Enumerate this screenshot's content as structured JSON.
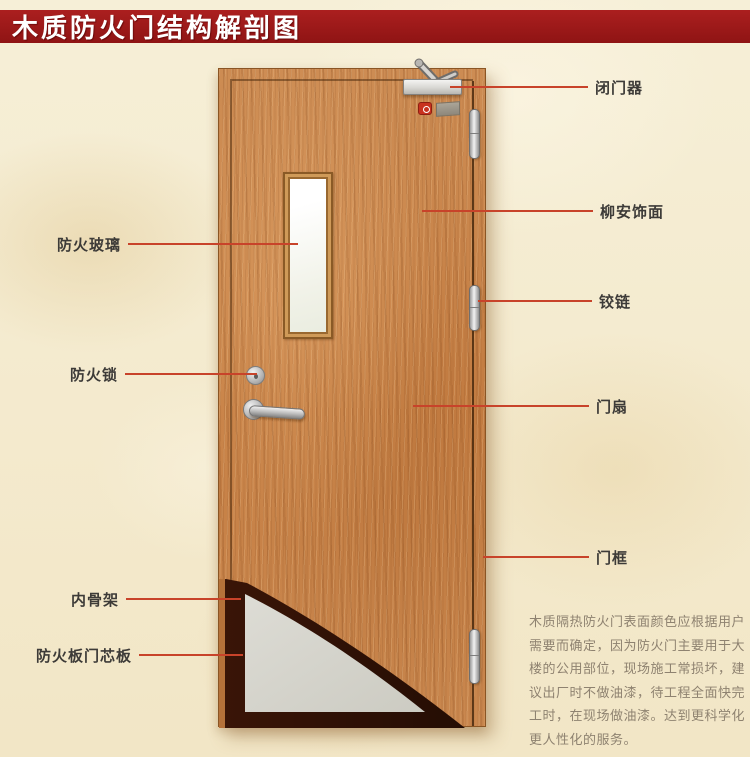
{
  "title": {
    "text": "木质防火门结构解剖图"
  },
  "labels": {
    "left": [
      {
        "text": "防火玻璃"
      },
      {
        "text": "防火锁"
      },
      {
        "text": "内骨架"
      },
      {
        "text": "防火板门芯板"
      }
    ],
    "right": [
      {
        "text": "闭门器"
      },
      {
        "text": "柳安饰面"
      },
      {
        "text": "铰链"
      },
      {
        "text": "门扇"
      },
      {
        "text": "门框"
      }
    ]
  },
  "description": {
    "lines": [
      "木质隔热防火门表面颜色应根据用户",
      "需要而确定，因为防火门主要用于大",
      "楼的公用部位，现场施工常损坏，建",
      "议出厂时不做油漆，待工程全面快完",
      "工时，在现场做油漆。达到更科学化",
      "更人性化的服务。"
    ]
  },
  "colors": {
    "banner": "#9e1b1b",
    "callout_line": "#c8432a",
    "label_text": "#3d3b38",
    "door_wood": "#c9854e",
    "core_board": "#d6d5cd",
    "skeleton": "#2e1105",
    "background": "#f3ead0"
  }
}
